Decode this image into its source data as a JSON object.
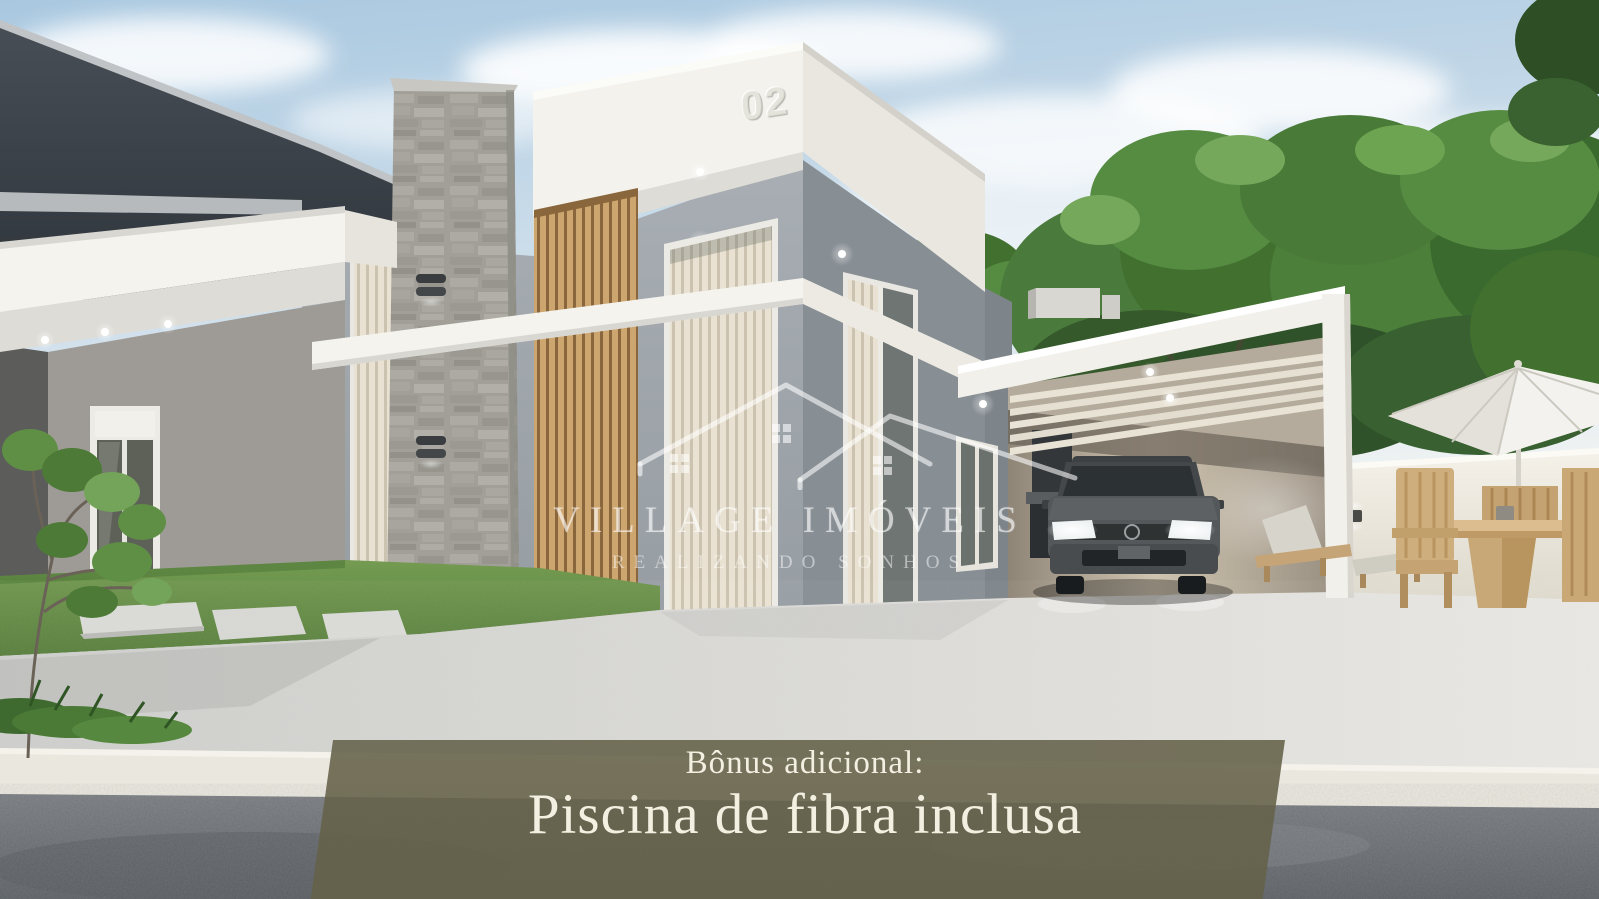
{
  "watermark": {
    "brand": "VILLAGE IMÓVEIS",
    "tagline": "REALIZANDO SONHOS",
    "logo_icon": "overlapping-house-roofs"
  },
  "building": {
    "unit_number": "02"
  },
  "banner": {
    "line1": "Bônus adicional:",
    "line2": "Piscina de fibra inclusa",
    "background_color": "#64614A",
    "text_color": "#F3EFE1"
  },
  "scene": {
    "palette": {
      "sky_blue": "#AECBE2",
      "foliage_green": "#4A7A38",
      "fascia_white": "#F3F2ED",
      "wall_gray": "#9AA1A7",
      "dark_building": "#3A4149",
      "wood_slats": "#C59C66",
      "stone_gray": "#A19F98",
      "driveway_concrete": "#D7D8D5",
      "road_asphalt": "#6E7377",
      "banner_olive": "#64614A"
    }
  }
}
